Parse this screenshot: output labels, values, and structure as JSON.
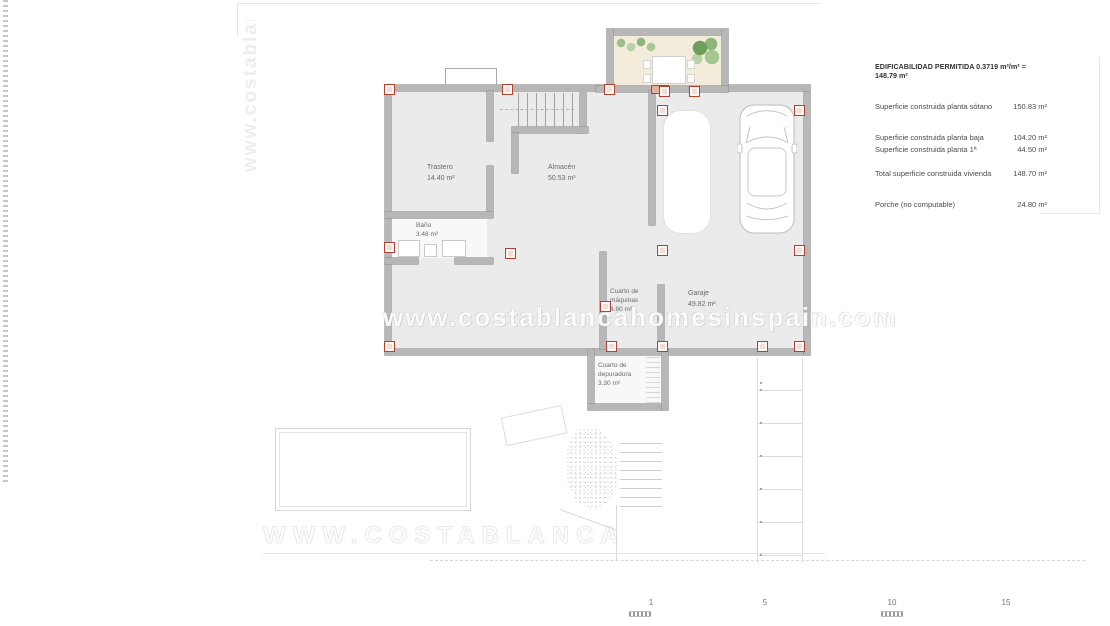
{
  "watermark": {
    "url": "www.costablancahomesinspain.com"
  },
  "legend": {
    "title": "EDIFICABILIDAD PERMITIDA 0.3719 m²/m² = 148.79 m²",
    "rows": [
      {
        "label": "Superficie construida planta sótano",
        "value": "150.83 m²"
      },
      {
        "label": "Superficie construida planta baja",
        "value": "104.20 m²"
      },
      {
        "label": "Superficie construida planta 1ª",
        "value": "44.50 m²"
      },
      {
        "label": "Total superficie construida vivienda",
        "value": "148.70 m²"
      },
      {
        "label": "Porche (no computable)",
        "value": "24.80 m²"
      }
    ]
  },
  "plan": {
    "rooms": [
      {
        "name": "Trastero",
        "area": "14.40 m²"
      },
      {
        "name": "Baño",
        "area": "3.48 m²"
      },
      {
        "name": "Almacén",
        "area": "50.53 m²"
      },
      {
        "name": "Cuarto de máquinas",
        "area": "4.80 m²"
      },
      {
        "name": "Garaje",
        "area": "49.82 m²"
      },
      {
        "name": "Cuarto de depuradora",
        "area": "3.30 m²"
      }
    ]
  },
  "scale_bar": {
    "labels": [
      "1",
      "5",
      "10",
      "15"
    ]
  },
  "colors": {
    "wall": "#b7b7b7",
    "wall_edge": "#8f8f8f",
    "floor": "#ebebeb",
    "pillar_red": "#b5402f",
    "pillar_fill": "#f2ddd4",
    "patio_floor": "#f3ecdb",
    "plant_green": "#7ba567",
    "door_fill": "#e6b09c"
  }
}
